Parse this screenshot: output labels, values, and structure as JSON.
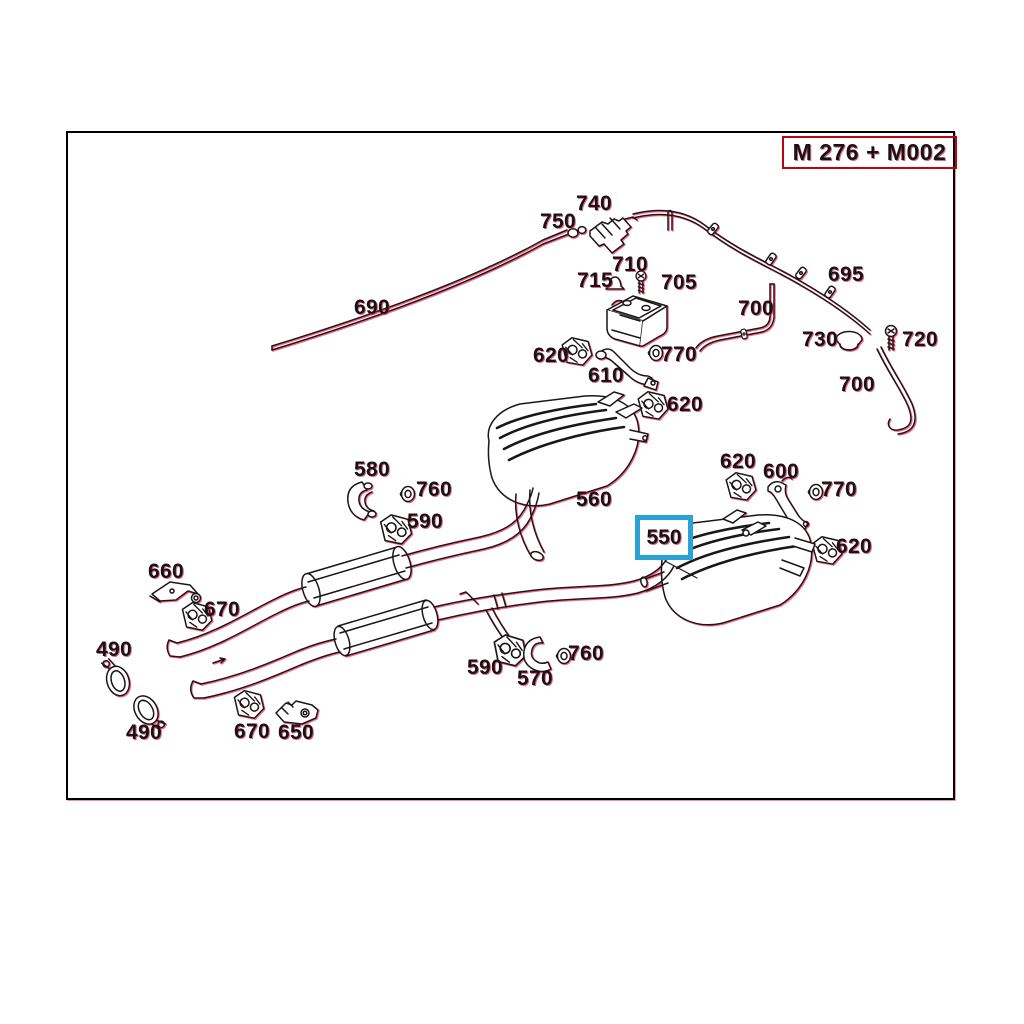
{
  "header": {
    "model_code": "M 276 + M002"
  },
  "diagram": {
    "highlighted_label": {
      "text": "550"
    },
    "labels": [
      {
        "text": "740"
      },
      {
        "text": "750"
      },
      {
        "text": "710"
      },
      {
        "text": "715"
      },
      {
        "text": "705"
      },
      {
        "text": "690"
      },
      {
        "text": "695"
      },
      {
        "text": "700"
      },
      {
        "text": "730"
      },
      {
        "text": "720"
      },
      {
        "text": "700"
      },
      {
        "text": "620"
      },
      {
        "text": "770"
      },
      {
        "text": "610"
      },
      {
        "text": "620"
      },
      {
        "text": "580"
      },
      {
        "text": "760"
      },
      {
        "text": "590"
      },
      {
        "text": "560"
      },
      {
        "text": "620"
      },
      {
        "text": "600"
      },
      {
        "text": "770"
      },
      {
        "text": "620"
      },
      {
        "text": "660"
      },
      {
        "text": "670"
      },
      {
        "text": "490"
      },
      {
        "text": "490"
      },
      {
        "text": "670"
      },
      {
        "text": "650"
      },
      {
        "text": "590"
      },
      {
        "text": "570"
      },
      {
        "text": "760"
      }
    ],
    "colors": {
      "highlight": "#29a3d6",
      "title_border": "#c00014",
      "ink": "#1a1416",
      "fringe": "#ef3a62"
    }
  }
}
